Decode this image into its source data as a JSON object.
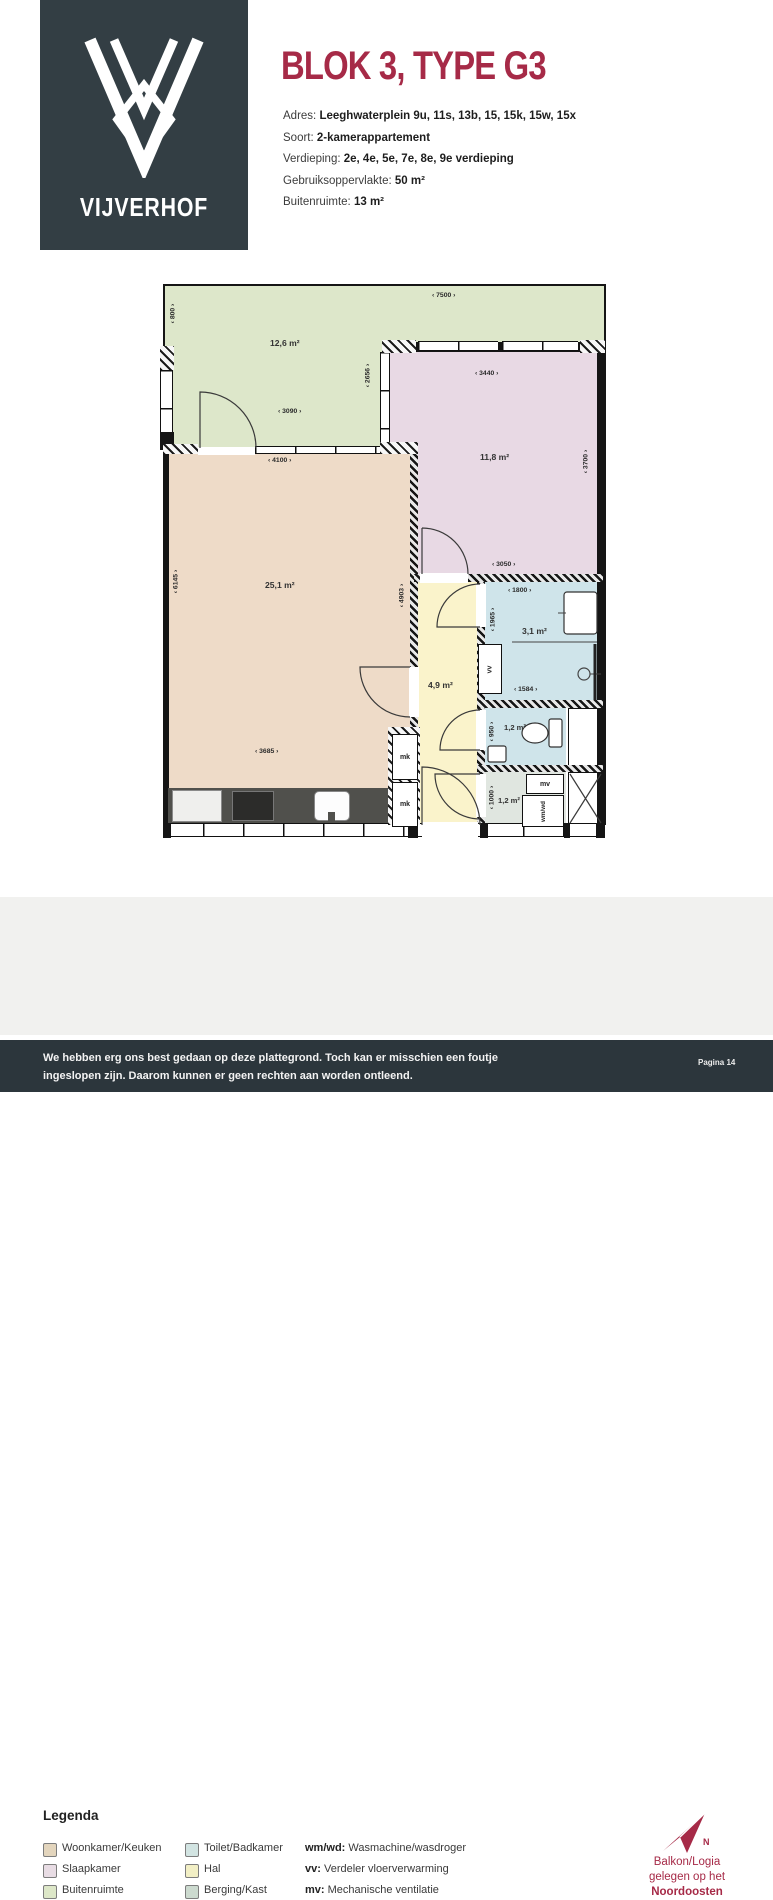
{
  "logo": {
    "name": "VIJVERHOF"
  },
  "header": {
    "title": "BLOK 3, TYPE G3",
    "details": [
      {
        "label": "Adres:",
        "value": "Leeghwaterplein 9u, 11s, 13b, 15, 15k, 15w, 15x"
      },
      {
        "label": "Soort:",
        "value": "2-kamerappartement"
      },
      {
        "label": "Verdieping:",
        "value": "2e, 4e, 5e, 7e, 8e, 9e verdieping"
      },
      {
        "label": "Gebruiksoppervlakte:",
        "value": "50 m²"
      },
      {
        "label": "Buitenruimte:",
        "value": "13 m²"
      }
    ]
  },
  "colors": {
    "accent": "#a62a47",
    "dark": "#2c363c",
    "logo_dark": "#333e44",
    "living": "#eedbc8",
    "bedroom": "#e8d9e4",
    "balcony": "#dde7ca",
    "bathroom": "#cfe4ea",
    "hall": "#faf3cb",
    "storage": "#e0e6e0"
  },
  "floorplan": {
    "areas": {
      "balcony": "12,6 m²",
      "bedroom": "11,8 m²",
      "living": "25,1 m²",
      "hall": "4,9 m²",
      "bathroom": "3,1 m²",
      "toilet": "1,2 m²",
      "storage": "1,2 m²"
    },
    "dimensions": {
      "balcony_left_v": "‹ 800 ›",
      "balcony_top_h": "‹ 7500 ›",
      "balcony_mid_h": "‹ 3090 ›",
      "balcony_right_v": "‹ 2656 ›",
      "bedroom_top_h": "‹ 3440 ›",
      "bedroom_right_v": "‹ 3700 ›",
      "bedroom_bottom_h": "‹ 3050 ›",
      "living_top_h": "‹ 4100 ›",
      "living_left_v": "‹ 6145 ›",
      "living_right_v": "‹ 4903 ›",
      "living_bottom_h": "‹ 3685 ›",
      "bathroom_top_h": "‹ 1800 ›",
      "bathroom_left_v": "‹ 1965 ›",
      "bathroom_bottom_h": "‹ 1584 ›",
      "toilet_left_v": "‹ 950 ›",
      "storage_left_v": "‹ 1000 ›"
    },
    "markers": {
      "mk": "mk",
      "mv": "mv",
      "vv": "vv",
      "wmwd": "wm/wd"
    }
  },
  "legend": {
    "title": "Legenda",
    "rooms": [
      {
        "label": "Woonkamer/Keuken",
        "color": "#e3d5bd"
      },
      {
        "label": "Slaapkamer",
        "color": "#e8dce4"
      },
      {
        "label": "Buitenruimte",
        "color": "#dde7c8"
      },
      {
        "label": "Toilet/Badkamer",
        "color": "#d2e4e2"
      },
      {
        "label": "Hal",
        "color": "#f2efc5"
      },
      {
        "label": "Berging/Kast",
        "color": "#ccdacf"
      }
    ],
    "abbreviations": [
      {
        "abbr": "wm/wd:",
        "meaning": "Wasmachine/wasdroger"
      },
      {
        "abbr": "vv:",
        "meaning": "Verdeler vloerverwarming"
      },
      {
        "abbr": "mv:",
        "meaning": "Mechanische ventilatie"
      }
    ]
  },
  "compass": {
    "line1": "Balkon/Logia",
    "line2": "gelegen op het",
    "line3": "Noordoosten"
  },
  "footer": {
    "line1": "We hebben erg ons best gedaan op deze plattegrond. Toch kan er misschien een foutje",
    "line2": "ingeslopen zijn. Daarom kunnen er geen rechten aan worden ontleend.",
    "page": "Pagina 14"
  }
}
